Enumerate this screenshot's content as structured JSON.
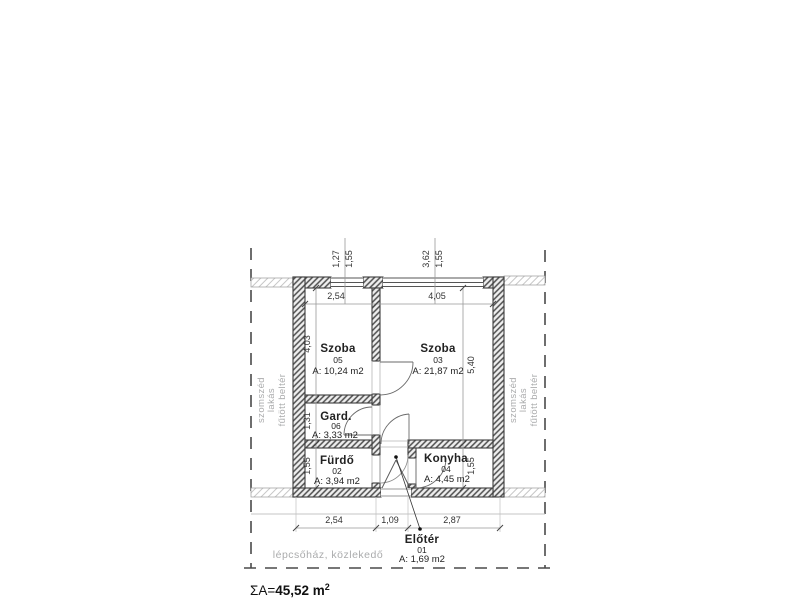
{
  "summary": {
    "prefix": "ΣA=",
    "value": "45,52 m",
    "sup": "2"
  },
  "rooms": {
    "szoba05": {
      "name": "Szoba",
      "num": "05",
      "area": "A: 10,24 m2"
    },
    "szoba03": {
      "name": "Szoba",
      "num": "03",
      "area": "A: 21,87 m2"
    },
    "gard": {
      "name": "Gard.",
      "num": "06",
      "area": "A: 3,33 m2"
    },
    "furdo": {
      "name": "Fürdő",
      "num": "02",
      "area": "A: 3,94 m2"
    },
    "konyha": {
      "name": "Konyha",
      "num": "04",
      "area": "A: 4,45 m2"
    },
    "eloter": {
      "name": "Előtér",
      "num": "01",
      "area": "A: 1,69 m2"
    }
  },
  "dims": {
    "top_left_room": "2,54",
    "top_right_room": "4,05",
    "win1_a": "1,27",
    "win1_b": "1,55",
    "win2_a": "3,62",
    "win2_b": "1,55",
    "left_a": "4,03",
    "left_b": "1,31",
    "left_c": "1,55",
    "right_a": "5,40",
    "right_b": "1,55",
    "bottom_a": "2,54",
    "bottom_b": "1,09",
    "bottom_c": "2,87"
  },
  "labels": {
    "neighbor_line1": "szomszéd",
    "neighbor_line2": "lakás",
    "neighbor_line3": "fűtött beltér",
    "stairwell": "lépcsőház, közlekedő"
  },
  "colors": {
    "wall": "#3d3d3d",
    "dim_line": "#999999",
    "muted_text": "#aaabac"
  }
}
